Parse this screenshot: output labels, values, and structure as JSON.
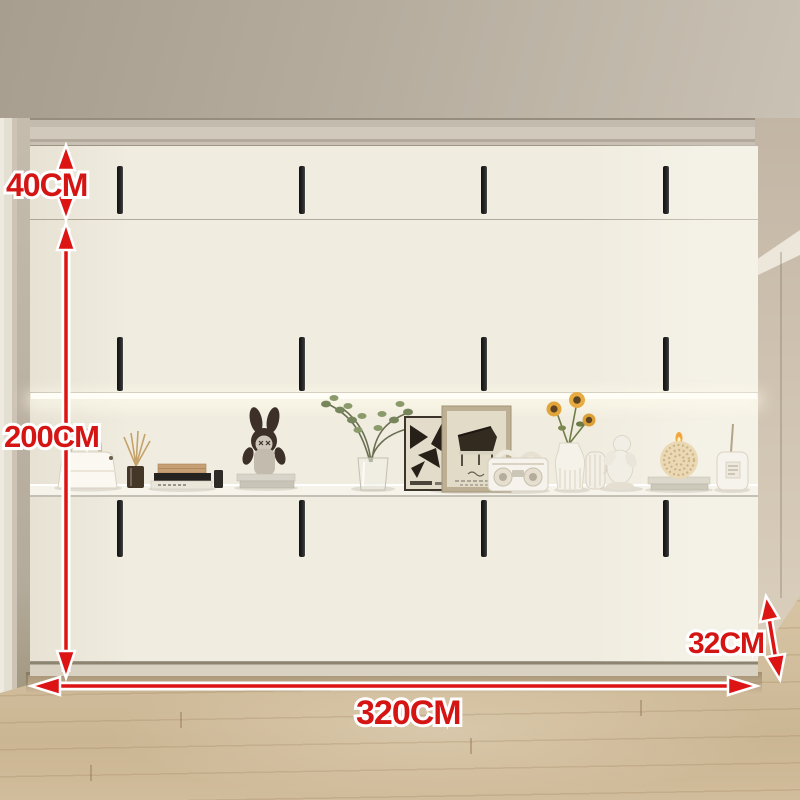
{
  "annotations": {
    "top_cabinet_height": "40CM",
    "main_height": "200CM",
    "total_width": "320CM",
    "side_depth": "32CM",
    "arrow_color": "#dd1414"
  },
  "cabinet": {
    "door_columns": 8,
    "rows": [
      "top storage cabinets",
      "tall upper doors",
      "open display niche with LED strip",
      "lower doors",
      "plinth"
    ],
    "door_color": "#f0ecdf",
    "handle_color": "#1a1a1a",
    "handle_count": 12
  },
  "display_shelf_items": [
    "white handbag",
    "reed diffuser",
    "stack of books with tan box",
    "small black box",
    "cartoon bunny figurine on books",
    "green plant in glass vase",
    "black-white abstract poster",
    "framed piano sketch",
    "white retro radio",
    "sunflowers in white vase",
    "small ribbed jug",
    "white cherub figurine",
    "round beaded candle on books",
    "white canister"
  ],
  "room": {
    "ceiling_color": "#b3aa9c",
    "wall_color": "#c8bbaa",
    "floor": "light oak wood planks"
  }
}
